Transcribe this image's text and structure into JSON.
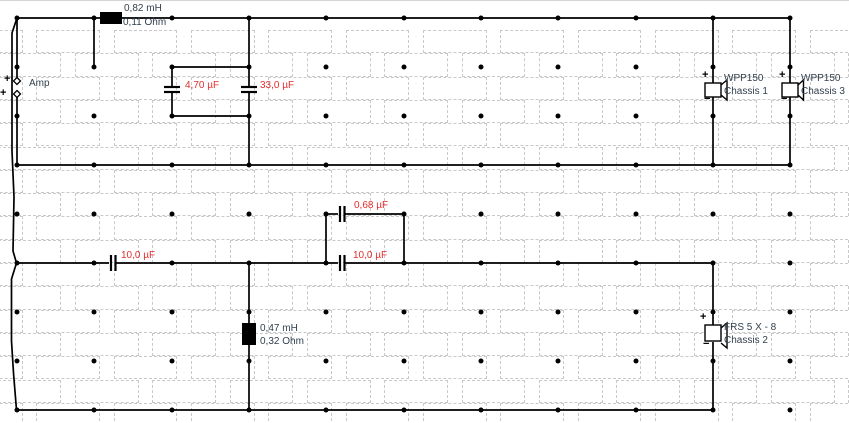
{
  "colors": {
    "wire": "#000000",
    "component_label": "#32404e",
    "value_label": "#e42e2e",
    "grid_cell_border": "#c9c9c9",
    "grid_dot": "#000000",
    "background": "#ffffff"
  },
  "components": {
    "amp": {
      "label": "Amp",
      "plus_upper": "+",
      "plus_lower": "+"
    },
    "inductor_top": {
      "inductance": "0,82 mH",
      "resistance": "0,11 Ohm"
    },
    "cap_parallel_top_1": {
      "value": "4,70 µF"
    },
    "cap_parallel_top_2": {
      "value": "33,0 µF"
    },
    "speaker1": {
      "model": "WPP150",
      "name": "Chassis 1",
      "plus": "+",
      "minus": "−"
    },
    "speaker3": {
      "model": "WPP150",
      "name": "Chassis 3",
      "plus": "+",
      "minus": "−"
    },
    "cap_parallel_bottom": {
      "value": "0,68 µF"
    },
    "cap_series_left": {
      "value": "10,0 µF"
    },
    "cap_series_mid": {
      "value": "10,0 µF"
    },
    "inductor_bottom": {
      "inductance": "0,47 mH",
      "resistance": "0,32 Ohm"
    },
    "speaker2": {
      "model": "FRS 5 X - 8",
      "name": "Chassis 2",
      "plus": "+",
      "minus": "−"
    }
  }
}
